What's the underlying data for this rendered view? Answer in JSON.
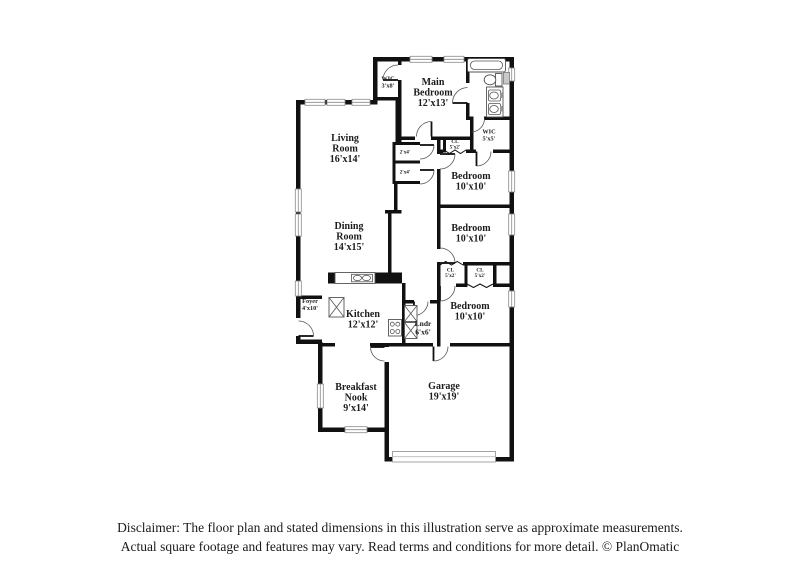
{
  "plan": {
    "colors": {
      "wall": "#111111",
      "label": "#1c1c1c",
      "window_frame": "#8a8a8a",
      "fixture_stroke": "#555555"
    },
    "fixture_icons": [
      "bathtub",
      "toilet",
      "double-sink-vanity",
      "kitchen-sink-counter",
      "stove",
      "washer-dryer",
      "pantry",
      "garage-door"
    ],
    "rooms": {
      "wic_top": {
        "lines": [
          "WIC",
          "3'x8'"
        ]
      },
      "main_bedroom": {
        "lines": [
          "Main",
          "Bedroom",
          "12'x13'"
        ]
      },
      "wic_right": {
        "lines": [
          "WIC",
          "5'x5'"
        ]
      },
      "cl_hall": {
        "lines": [
          "CL",
          "5'x2'"
        ]
      },
      "living_room": {
        "lines": [
          "Living",
          "Room",
          "16'x14'"
        ]
      },
      "closet_a": {
        "lines": [
          "2'x4'"
        ]
      },
      "closet_b": {
        "lines": [
          "2'x4'"
        ]
      },
      "bedroom_1": {
        "lines": [
          "Bedroom",
          "10'x10'"
        ]
      },
      "bedroom_2": {
        "lines": [
          "Bedroom",
          "10'x10'"
        ]
      },
      "cl_left": {
        "lines": [
          "CL",
          "5'x2'"
        ]
      },
      "cl_right": {
        "lines": [
          "CL",
          "5'x2'"
        ]
      },
      "dining_room": {
        "lines": [
          "Dining",
          "Room",
          "14'x15'"
        ]
      },
      "foyer": {
        "lines": [
          "Foyer",
          "4'x10'"
        ]
      },
      "kitchen": {
        "lines": [
          "Kitchen",
          "12'x12'"
        ]
      },
      "laundry": {
        "lines": [
          "Lndr",
          "6'x6'"
        ]
      },
      "bedroom_3": {
        "lines": [
          "Bedroom",
          "10'x10'"
        ]
      },
      "breakfast_nook": {
        "lines": [
          "Breakfast",
          "Nook",
          "9'x14'"
        ]
      },
      "garage": {
        "lines": [
          "Garage",
          "19'x19'"
        ]
      }
    }
  },
  "disclaimer": {
    "line1": "Disclaimer: The floor plan and stated dimensions in this illustration serve as approximate measurements.",
    "line2": "Actual square footage and features may vary. Read terms and conditions for more detail. © PlanOmatic"
  }
}
